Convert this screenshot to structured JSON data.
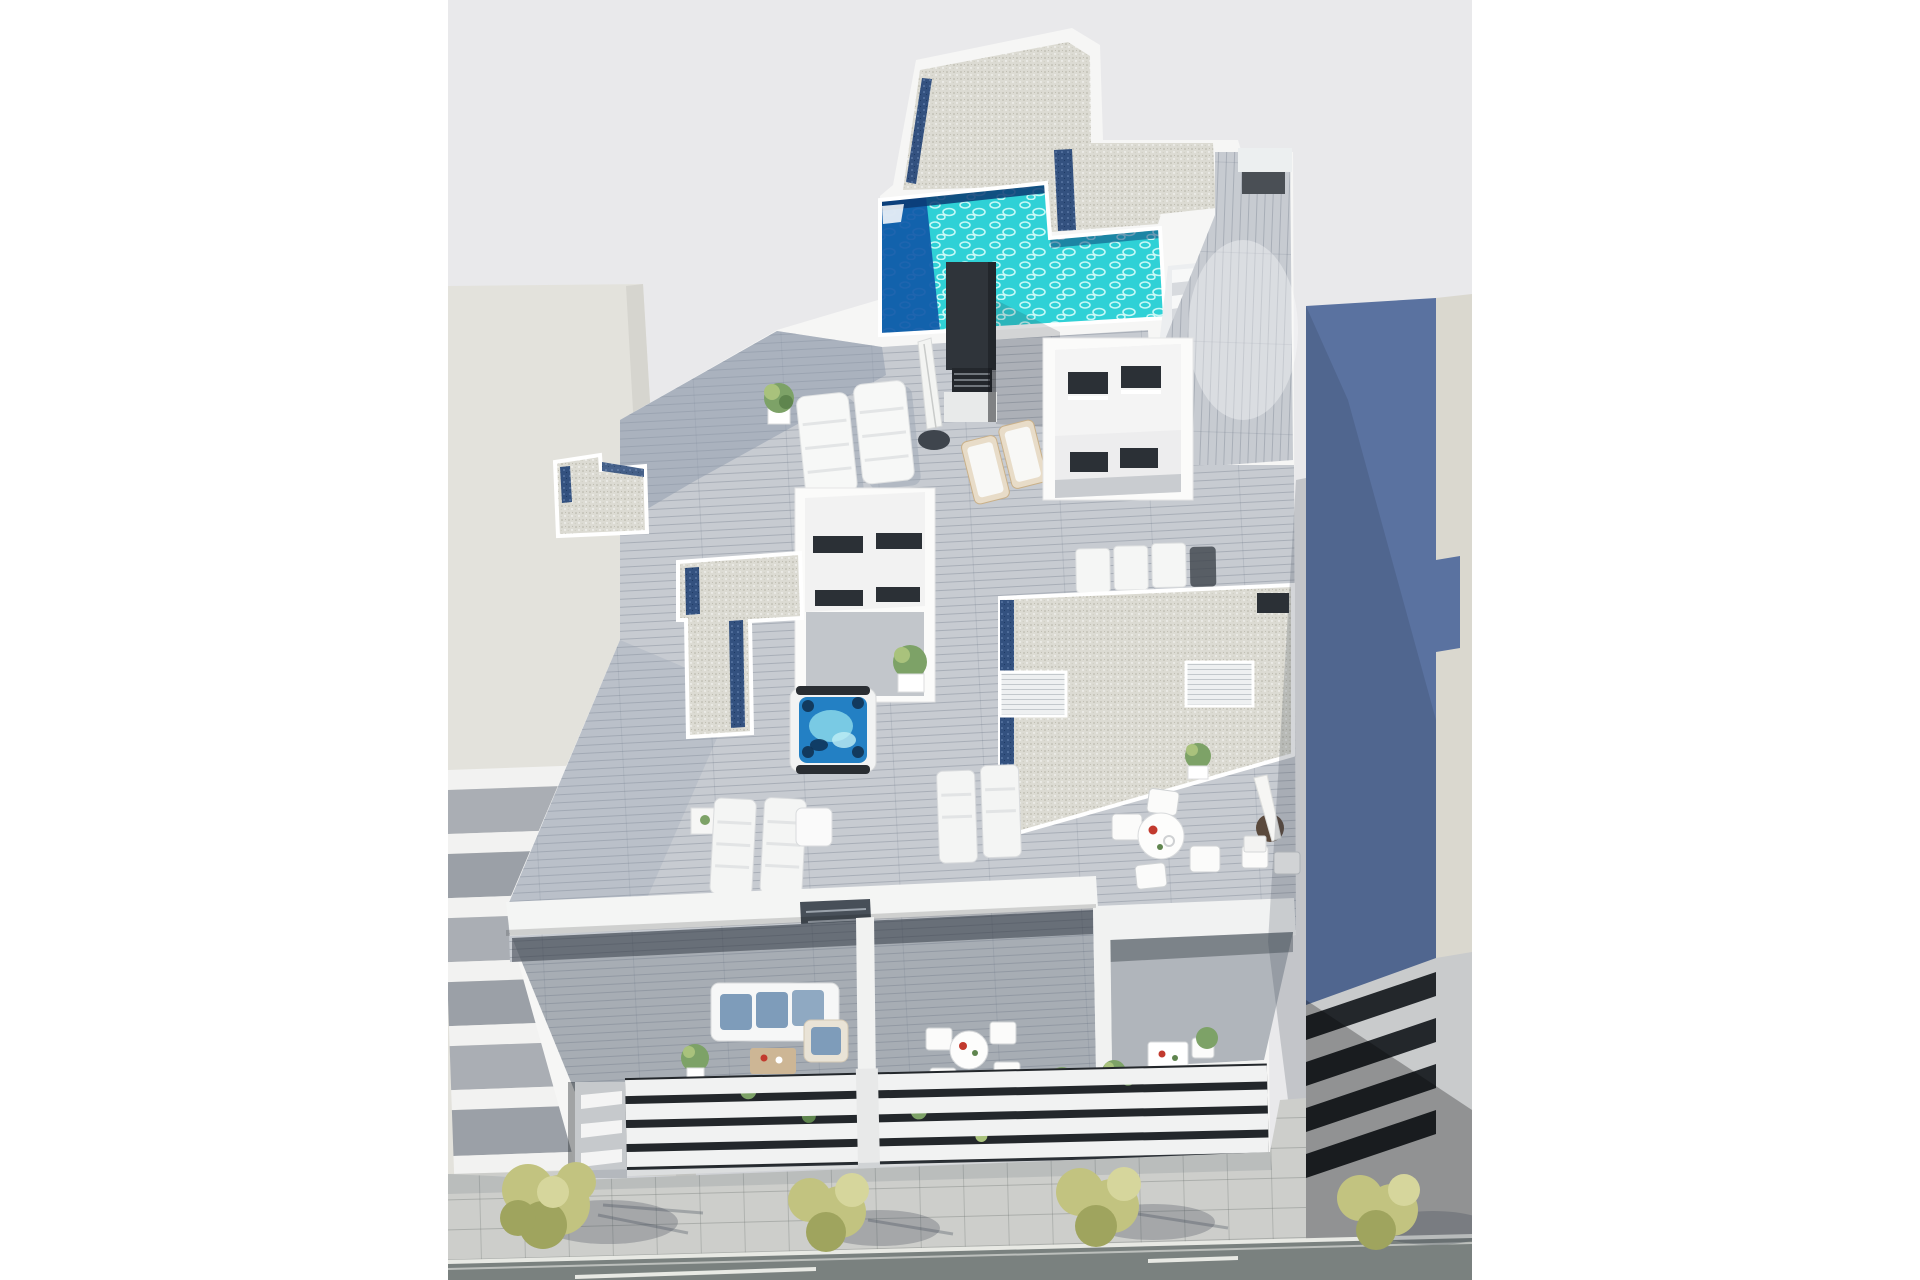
{
  "meta": {
    "title": "Aerial 3D architectural render of a residential building rooftop",
    "style": "white letterboxed visualization, top-down oblique view",
    "visible_text": "none"
  },
  "palette": {
    "bg": "#e9e9eb",
    "wall": "#f6f6f5",
    "wall-shade": "#e2e3e4",
    "beige": "#e3e2dc",
    "beige-side": "#d6d5cf",
    "stripe-gray": "#aaaeb4",
    "stripe-white": "#f2f2f1",
    "blue-bldg": "#5a72a0",
    "blue-bldg-side": "#dad8cf",
    "gravel": "#dcdbd3",
    "gravel-dot": "#b4b2a5",
    "gutter": "#33517f",
    "pool": "#2fd1d6",
    "pool-deep": "#1058a8",
    "pool-edge": "#0a3a72",
    "jacuzzi": "#2380c4",
    "jacuzzi-light": "#8edcec",
    "deck": "#c7cbd1",
    "deck-shadow": "#8e99ab",
    "win": "#2b3036",
    "cushion": "#7e9cba",
    "wood-warm": "#cdb695",
    "plant": "#7da267",
    "plant-light": "#a9c27c",
    "tree": "#c2c380",
    "tree-dark": "#9fa45e",
    "pave": "#cdcecb",
    "road": "#7a817f",
    "line-white": "#e8e9e4",
    "chimney": "#2f343a"
  },
  "scene": {
    "labels": {
      "render": "aerial render of penthouse roof terrace with pool",
      "left_building": "adjacent beige building with striped balcony floors",
      "right_building": "adjacent slate blue building",
      "main_building": "white residential building with roof terrace",
      "roof_gravel_top": "upper gravel roof with parapet and blue gutters",
      "pool": "L-shaped turquoise rooftop swimming pool",
      "pool_stairs": "white stairs from pool level to deck",
      "side_corridor": "sunlit wooden side walkway",
      "chimney": "dark ventilation chimney tower",
      "top_loungers": "two padded white sun loungers",
      "parasol_closed": "folded white parasol on round base",
      "deck_chairs": "two wooden deck chairs with white cushions",
      "lightwell_a": "light well with dark window openings",
      "lightwell_b": "light well with dark windows and interior patio plant",
      "gravel_left": "small gravel roof with blue gutter",
      "gravel_center": "T-shaped gravel roof with blue gutters",
      "jacuzzi": "square hot tub with blue water",
      "gravel_right": "large gravel roof with louvered skylight boxes",
      "loungers_row": "row of three flat white loungers",
      "mid_loungers": "pairs of white loungers on wooden deck",
      "dining_set": "round dining table with four white chairs",
      "parasol_set": "parasol with bistro table and chairs",
      "planters": "white planters with green shrubs",
      "front_parapet": "white front parapet of roof terrace",
      "lower_balcony": "lower terrace with sofa and tables",
      "sofa_set": "white sofa with blue cushions and coffee table",
      "facade": "street facade with white horizontal louvers",
      "sidewalk": "paved sidewalk with street trees",
      "road": "asphalt road with white markings",
      "trees": "four yellow-green street trees"
    }
  }
}
